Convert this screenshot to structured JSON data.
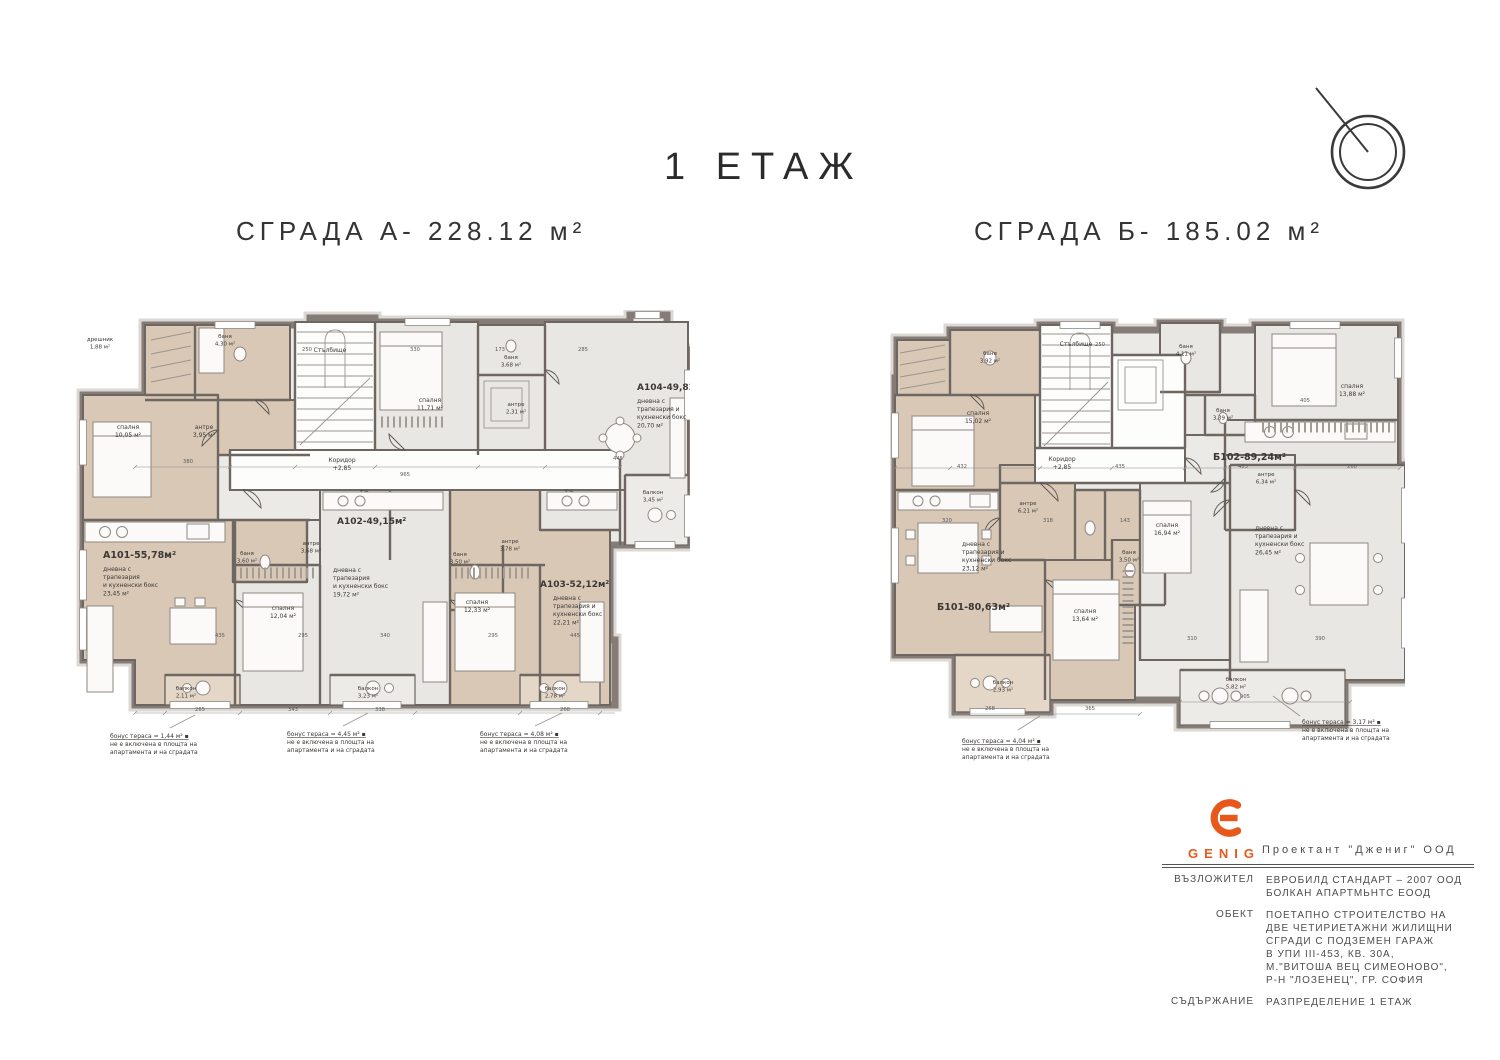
{
  "header": {
    "floor_title": "1 ЕТАЖ"
  },
  "buildings": {
    "a": {
      "heading": "СГРАДА А- 228.12 м²"
    },
    "b": {
      "heading": "СГРАДА Б- 185.02 м²"
    }
  },
  "plan_a": {
    "labels": [
      {
        "x": 25,
        "y": 31,
        "lines": [
          "дрешник",
          "1,88 м²"
        ],
        "size": 5.5
      },
      {
        "x": 150,
        "y": 28,
        "lines": [
          "баня",
          "4,30 м²"
        ],
        "size": 5.5
      },
      {
        "x": 255,
        "y": 42,
        "lines": [
          "Стълбище"
        ],
        "size": 6
      },
      {
        "x": 53,
        "y": 119,
        "lines": [
          "спалня",
          "10,05 м²"
        ],
        "size": 6
      },
      {
        "x": 129,
        "y": 119,
        "lines": [
          "антре",
          "3,95 м²"
        ],
        "size": 6
      },
      {
        "x": 267,
        "y": 152,
        "lines": [
          "Коридор",
          "+2,85"
        ],
        "size": 6
      },
      {
        "x": 355,
        "y": 92,
        "lines": [
          "спалня",
          "11,71 м²"
        ],
        "size": 6
      },
      {
        "x": 436,
        "y": 49,
        "lines": [
          "баня",
          "3,68 м²"
        ],
        "size": 5.5
      },
      {
        "x": 441,
        "y": 96,
        "lines": [
          "антре",
          "2,31 м²"
        ],
        "size": 5.5
      },
      {
        "x": 562,
        "y": 80,
        "lines": [
          "А104-49,82м²"
        ],
        "size": 9,
        "bold": true,
        "anchor": "start"
      },
      {
        "x": 562,
        "y": 93,
        "lines": [
          "дневна с",
          "трапезария и",
          "кухненски бокс",
          "20,70 м²"
        ],
        "size": 6,
        "anchor": "start"
      },
      {
        "x": 578,
        "y": 184,
        "lines": [
          "балкон",
          "3,45 м²"
        ],
        "size": 5.5
      },
      {
        "x": 28,
        "y": 248,
        "lines": [
          "А101-55,78м²"
        ],
        "size": 9.5,
        "bold": true,
        "anchor": "start"
      },
      {
        "x": 28,
        "y": 261,
        "lines": [
          "дневна с",
          "трапезария",
          "и кухненски бокс",
          "23,45 м²"
        ],
        "size": 6,
        "anchor": "start"
      },
      {
        "x": 172,
        "y": 245,
        "lines": [
          "баня",
          "3,60 м²"
        ],
        "size": 5.5
      },
      {
        "x": 208,
        "y": 300,
        "lines": [
          "спалня",
          "12,04 м²"
        ],
        "size": 6
      },
      {
        "x": 262,
        "y": 214,
        "lines": [
          "А102-49,15м²"
        ],
        "size": 9,
        "bold": true,
        "anchor": "start"
      },
      {
        "x": 236,
        "y": 235,
        "lines": [
          "антре",
          "3,68 м²"
        ],
        "size": 5.5
      },
      {
        "x": 258,
        "y": 262,
        "lines": [
          "дневна с",
          "трапезария",
          "и кухненски бокс",
          "19,72 м²"
        ],
        "size": 6,
        "anchor": "start"
      },
      {
        "x": 385,
        "y": 246,
        "lines": [
          "баня",
          "3,50 м²"
        ],
        "size": 5.5
      },
      {
        "x": 435,
        "y": 233,
        "lines": [
          "антре",
          "3,78 м²"
        ],
        "size": 5.5
      },
      {
        "x": 402,
        "y": 294,
        "lines": [
          "спалня",
          "12,33 м²"
        ],
        "size": 6
      },
      {
        "x": 465,
        "y": 277,
        "lines": [
          "А103-52,12м²"
        ],
        "size": 9,
        "bold": true,
        "anchor": "start"
      },
      {
        "x": 478,
        "y": 290,
        "lines": [
          "дневна с",
          "трапезария и",
          "кухненски бокс",
          "22,21 м²"
        ],
        "size": 6,
        "anchor": "start"
      },
      {
        "x": 111,
        "y": 380,
        "lines": [
          "балкон",
          "2,11 м²"
        ],
        "size": 5.5
      },
      {
        "x": 293,
        "y": 380,
        "lines": [
          "балкон",
          "3,23 м²"
        ],
        "size": 5.5
      },
      {
        "x": 480,
        "y": 380,
        "lines": [
          "балкон",
          "2,78 м²"
        ],
        "size": 5.5
      },
      {
        "x": 35,
        "y": 428,
        "lines": [
          "бонус тераса = 1,44 м² ▪",
          "не е включена в площта на",
          "апартамента и на сградата"
        ],
        "size": 6,
        "anchor": "start",
        "u": true
      },
      {
        "x": 212,
        "y": 426,
        "lines": [
          "бонус тераса = 4,45 м² ▪",
          "не е включена в площта на",
          "апартамента и на сградата"
        ],
        "size": 6,
        "anchor": "start",
        "u": true
      },
      {
        "x": 405,
        "y": 426,
        "lines": [
          "бонус тераса = 4,08 м² ▪",
          "не е включена в площта на",
          "апартамента и на сградата"
        ],
        "size": 6,
        "anchor": "start",
        "u": true
      }
    ],
    "dims": [
      {
        "x": 232,
        "y": 41,
        "t": "250"
      },
      {
        "x": 340,
        "y": 41,
        "t": "330"
      },
      {
        "x": 425,
        "y": 41,
        "t": "173"
      },
      {
        "x": 508,
        "y": 41,
        "t": "285"
      },
      {
        "x": 113,
        "y": 153,
        "t": "380"
      },
      {
        "x": 330,
        "y": 166,
        "t": "965"
      },
      {
        "x": 543,
        "y": 150,
        "t": "445"
      },
      {
        "x": 145,
        "y": 327,
        "t": "435"
      },
      {
        "x": 228,
        "y": 327,
        "t": "295"
      },
      {
        "x": 310,
        "y": 327,
        "t": "340"
      },
      {
        "x": 418,
        "y": 327,
        "t": "295"
      },
      {
        "x": 500,
        "y": 327,
        "t": "445"
      },
      {
        "x": 125,
        "y": 401,
        "t": "265"
      },
      {
        "x": 218,
        "y": 401,
        "t": "343"
      },
      {
        "x": 305,
        "y": 401,
        "t": "338"
      },
      {
        "x": 490,
        "y": 401,
        "t": "268"
      }
    ]
  },
  "plan_b": {
    "labels": [
      {
        "x": 100,
        "y": 37,
        "lines": [
          "баня",
          "3,92 м²"
        ],
        "size": 5.5
      },
      {
        "x": 186,
        "y": 28,
        "lines": [
          "Стълбище"
        ],
        "size": 6
      },
      {
        "x": 296,
        "y": 30,
        "lines": [
          "баня",
          "4,11 м²"
        ],
        "size": 5.5
      },
      {
        "x": 88,
        "y": 97,
        "lines": [
          "спалня",
          "15,02 м²"
        ],
        "size": 6
      },
      {
        "x": 172,
        "y": 143,
        "lines": [
          "Коридор",
          "+2,85"
        ],
        "size": 6
      },
      {
        "x": 138,
        "y": 187,
        "lines": [
          "антре",
          "6,21 м²"
        ],
        "size": 5.5
      },
      {
        "x": 277,
        "y": 209,
        "lines": [
          "спалня",
          "16,94 м²"
        ],
        "size": 6
      },
      {
        "x": 72,
        "y": 228,
        "lines": [
          "дневна с",
          "трапезария и",
          "кухненски бокс",
          "23,12 м²"
        ],
        "size": 6,
        "anchor": "start"
      },
      {
        "x": 47,
        "y": 292,
        "lines": [
          "Б101-80,63м²"
        ],
        "size": 9.5,
        "bold": true,
        "anchor": "start"
      },
      {
        "x": 195,
        "y": 295,
        "lines": [
          "спалня",
          "13,64 м²"
        ],
        "size": 6
      },
      {
        "x": 239,
        "y": 236,
        "lines": [
          "баня",
          "3,50 м²"
        ],
        "size": 5.5
      },
      {
        "x": 113,
        "y": 366,
        "lines": [
          "балкон",
          "2,93 м²"
        ],
        "size": 5.5
      },
      {
        "x": 323,
        "y": 142,
        "lines": [
          "Б102-89,24м²"
        ],
        "size": 9.5,
        "bold": true,
        "anchor": "start"
      },
      {
        "x": 333,
        "y": 94,
        "lines": [
          "баня",
          "3,39 м²"
        ],
        "size": 5.5
      },
      {
        "x": 462,
        "y": 70,
        "lines": [
          "спалня",
          "13,88 м²"
        ],
        "size": 6
      },
      {
        "x": 376,
        "y": 158,
        "lines": [
          "антре",
          "6,34 м²"
        ],
        "size": 5.5
      },
      {
        "x": 365,
        "y": 212,
        "lines": [
          "дневна с",
          "трапезария и",
          "кухненски бокс",
          "26,45 м²"
        ],
        "size": 6,
        "anchor": "start"
      },
      {
        "x": 346,
        "y": 363,
        "lines": [
          "балкон",
          "5,82 м²"
        ],
        "size": 5.5
      },
      {
        "x": 72,
        "y": 425,
        "lines": [
          "бонус тераса = 4,04 м² ▪",
          "не е включена в площта на",
          "апартамента и на сградата"
        ],
        "size": 6,
        "anchor": "start",
        "u": true
      },
      {
        "x": 412,
        "y": 406,
        "lines": [
          "бонус тераса = 3,17 м² ▪",
          "не е включена в площта на",
          "апартамента и на сградата"
        ],
        "size": 6,
        "anchor": "start",
        "u": true
      }
    ],
    "dims": [
      {
        "x": 210,
        "y": 28,
        "t": "250"
      },
      {
        "x": 415,
        "y": 84,
        "t": "405"
      },
      {
        "x": 72,
        "y": 150,
        "t": "432"
      },
      {
        "x": 230,
        "y": 150,
        "t": "435"
      },
      {
        "x": 353,
        "y": 150,
        "t": "483"
      },
      {
        "x": 462,
        "y": 150,
        "t": "260"
      },
      {
        "x": 57,
        "y": 204,
        "t": "320"
      },
      {
        "x": 158,
        "y": 204,
        "t": "318"
      },
      {
        "x": 235,
        "y": 204,
        "t": "143"
      },
      {
        "x": 302,
        "y": 322,
        "t": "310"
      },
      {
        "x": 430,
        "y": 322,
        "t": "390"
      },
      {
        "x": 100,
        "y": 392,
        "t": "268"
      },
      {
        "x": 200,
        "y": 392,
        "t": "365"
      },
      {
        "x": 355,
        "y": 380,
        "t": "905"
      }
    ]
  },
  "title_block": {
    "logo_text": "GENIG",
    "designer": "Проектант  \"Джениг\"  ООД",
    "accent_color": "#e8581a",
    "rows": [
      {
        "label": "ВЪЗЛОЖИТЕЛ",
        "lines": [
          "ЕВРОБИЛД СТАНДАРТ – 2007 ООД",
          "БОЛКАН АПАРТМЬНТС ЕООД"
        ]
      },
      {
        "label": "ОБЕКТ",
        "lines": [
          "ПОЕТАПНО СТРОИТЕЛСТВО НА",
          "ДВЕ ЧЕТИРИЕТАЖНИ ЖИЛИЩНИ",
          "СГРАДИ С ПОДЗЕМЕН ГАРАЖ",
          "В УПИ III-453, КВ. 30А,",
          "М.\"ВИТОША ВЕЦ СИМЕОНОВО\",",
          "Р-Н \"ЛОЗЕНЕЦ\", ГР. СОФИЯ"
        ]
      },
      {
        "label": "СЪДЪРЖАНИЕ",
        "lines": [
          "РАЗПРЕДЕЛЕНИЕ 1 ЕТАЖ"
        ]
      }
    ]
  }
}
